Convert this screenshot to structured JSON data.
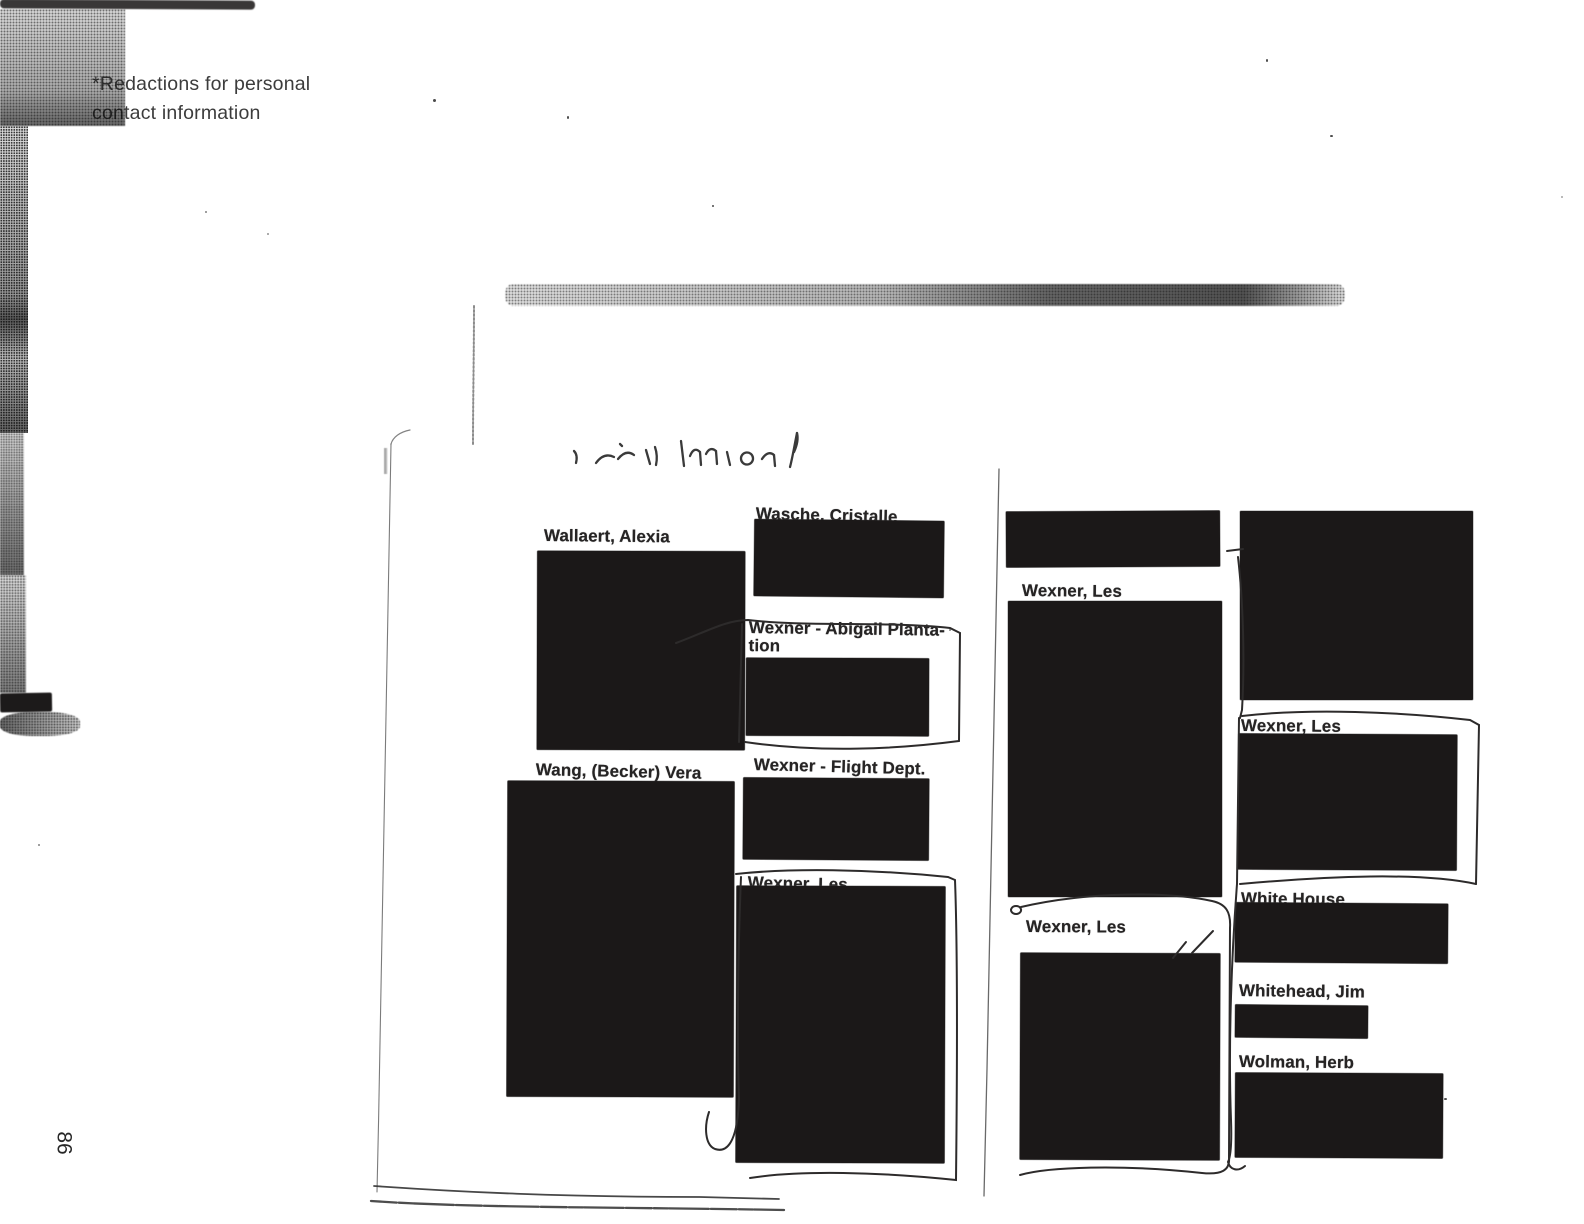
{
  "document": {
    "kind": "redacted address-book scan",
    "note": {
      "line1": "*Redactions for personal",
      "line2": "contact information"
    },
    "page_number": "86"
  },
  "entries": {
    "wallaert": {
      "label": "Wallaert, Alexia"
    },
    "wang": {
      "label": "Wang, (Becker) Vera"
    },
    "wasche": {
      "label": "Wasche, Cristalle"
    },
    "wexner_abigail": {
      "label_line1": "Wexner - Abigail Planta-",
      "label_line2": "tion"
    },
    "wexner_flight": {
      "label": "Wexner - Flight Dept."
    },
    "wexner_les_center": {
      "label": "Wexner, Les"
    },
    "wexner_les_col3_top": {
      "label": "Wexner, Les"
    },
    "wexner_les_col3_bottom": {
      "label": "Wexner, Les"
    },
    "wexner_les_col4": {
      "label": "Wexner, Les"
    },
    "white_house": {
      "label": "White House"
    },
    "whitehead": {
      "label": "Whitehead, Jim"
    },
    "wolman": {
      "label": "Wolman, Herb"
    }
  },
  "colors": {
    "paper": "#ffffff",
    "redaction_box": "#1b1818",
    "pen_ink": "#2d2b2b",
    "note_text": "#3c3c3c"
  }
}
